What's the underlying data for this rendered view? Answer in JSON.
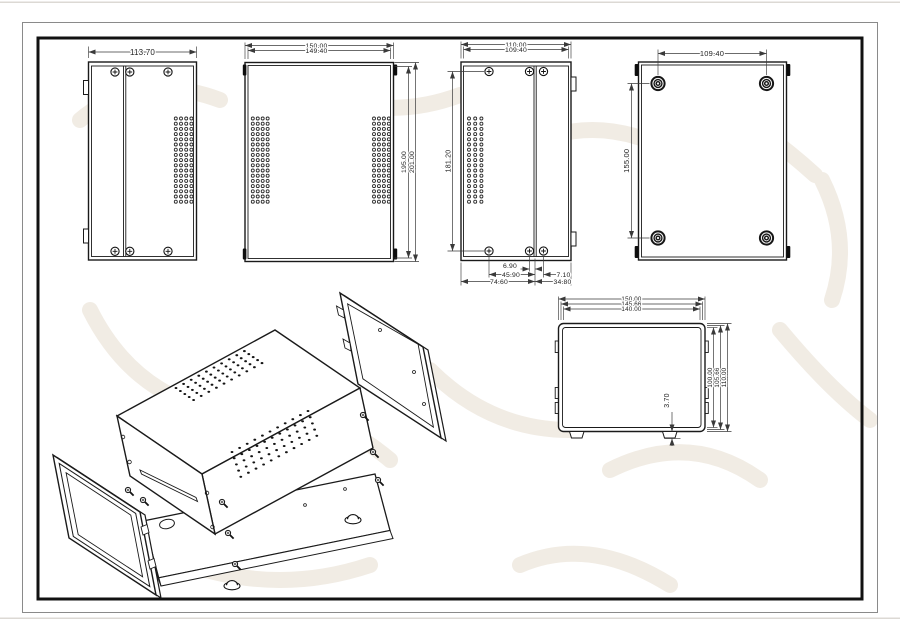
{
  "colors": {
    "paper": "#ffffff",
    "line": "#1a1a1a",
    "dim": "#3a3a3a",
    "watermark": "#f1ece4",
    "frame_outer": "#8a8a8a",
    "frame_inner": "#111111"
  },
  "views": {
    "side_left": {
      "width": "113.70"
    },
    "top": {
      "width_outer": "150.00",
      "width_inner": "149.40",
      "depth_inner": "195.00",
      "depth_outer": "201.00"
    },
    "side_right": {
      "width_outer": "110.00",
      "width_inner": "109.40",
      "screw_span": "181.20",
      "bottom_d1": "6.90",
      "bottom_d2": "45.90",
      "bottom_d3": "74.60",
      "bottom_d4": "7.10",
      "bottom_d5": "34.80"
    },
    "bottom": {
      "feet_span_width": "109.40",
      "feet_span_depth": "155.00"
    },
    "front": {
      "width_outer": "150.00",
      "width_mid": "145.66",
      "width_inner": "140.00",
      "height_inner": "100.00",
      "height_mid": "105.66",
      "height_outer": "110.00",
      "foot_height": "3.70"
    }
  }
}
